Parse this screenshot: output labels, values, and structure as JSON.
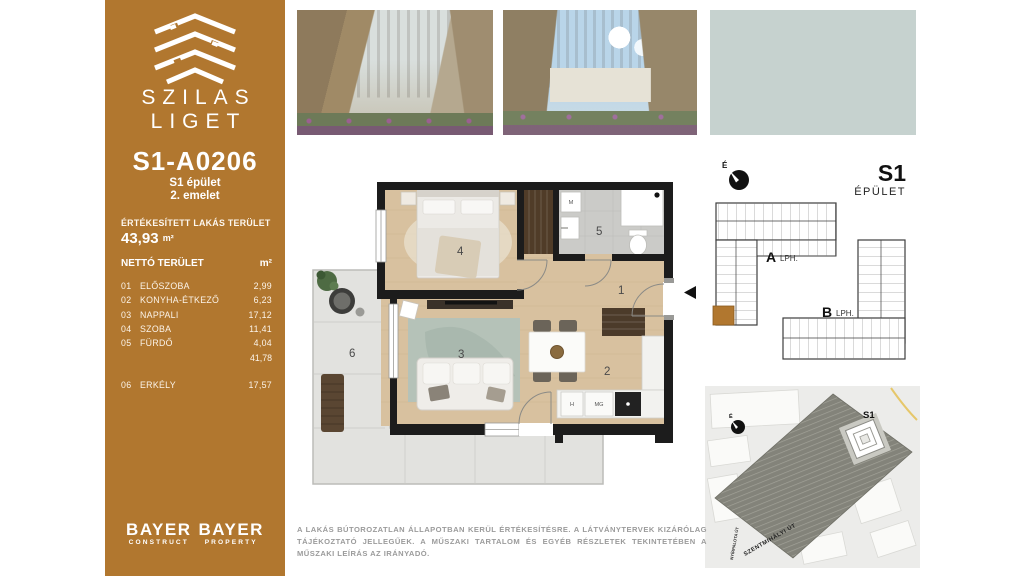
{
  "colors": {
    "brand_brown": "#b1772f",
    "wall_black": "#1c1c1c",
    "wood_floor": "#d8c19f",
    "tile_gray": "#cbcbc8",
    "concrete": "#e2e2df",
    "disclaimer_gray": "#9b9b9b"
  },
  "brand": {
    "line1": "SZILAS",
    "line2": "LIGET"
  },
  "unit": {
    "id": "S1-A0206",
    "building": "S1 épület",
    "floor": "2. emelet"
  },
  "sold_area": {
    "label": "ÉRTÉKESÍTETT LAKÁS TERÜLET",
    "value": "43,93",
    "unit": "m²"
  },
  "net_table": {
    "label": "NETTÓ TERÜLET",
    "unit_header": "m²",
    "rows": [
      {
        "num": "01",
        "name": "ELŐSZOBA",
        "value": "2,99"
      },
      {
        "num": "02",
        "name": "KONYHA-ÉTKEZŐ",
        "value": "6,23"
      },
      {
        "num": "03",
        "name": "NAPPALI",
        "value": "17,12"
      },
      {
        "num": "04",
        "name": "SZOBA",
        "value": "11,41"
      },
      {
        "num": "05",
        "name": "FÜRDŐ",
        "value": "4,04"
      }
    ],
    "subtotal": "41,78",
    "balcony_row": {
      "num": "06",
      "name": "ERKÉLY",
      "value": "17,57"
    }
  },
  "footer_logos": {
    "construct_top": "BAYER",
    "construct_sub": "CONSTRUCT",
    "property_top": "BAYER",
    "property_sub": "PROPERTY"
  },
  "disclaimer": "A LAKÁS BÚTOROZATLAN ÁLLAPOTBAN KERÜL ÉRTÉKESÍTÉSRE. A LÁTVÁNYTERVEK KIZÁRÓLAG TÁJÉKOZTATÓ JELLEGŰEK. A MŰSZAKI TARTALOM ÉS EGYÉB RÉSZLETEK TEKINTETÉBEN A MŰSZAKI LEÍRÁS AZ IRÁNYADÓ.",
  "floor_plan": {
    "rooms": {
      "r1": "1",
      "r2": "2",
      "r3": "3",
      "r4": "4",
      "r5": "5",
      "r6": "6"
    },
    "appliances": {
      "washer": "M",
      "fridge": "H",
      "dishwasher": "MG"
    }
  },
  "key_plan": {
    "compass": "É",
    "title": "S1",
    "subtitle": "ÉPÜLET",
    "stair_a": "A",
    "stair_a_label": "LPH.",
    "stair_b": "B",
    "stair_b_label": "LPH."
  },
  "site_map": {
    "compass": "É",
    "building": "S1",
    "street_main": "SZENTMIHÁLYI ÚT",
    "street_side": "NYÍRPALOTA ÚT"
  }
}
